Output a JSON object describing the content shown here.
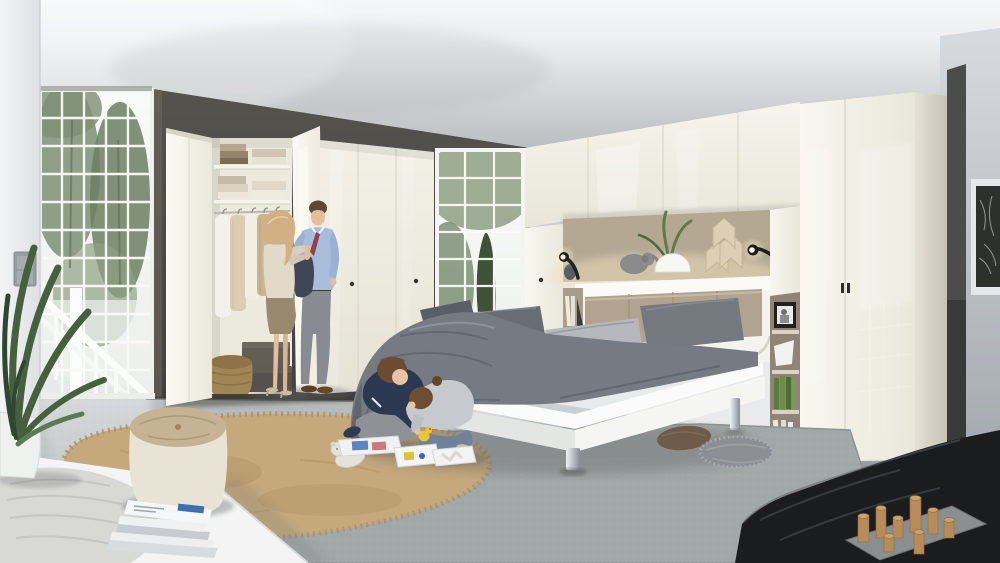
{
  "meta": {
    "type": "photograph",
    "subject": "Family of four in a bright showroom bedroom with white high-gloss fitted wardrobes, overbed storage bridge and grey bed"
  },
  "palette": {
    "accent_wall": "#55534e",
    "niche_taupe": "#b4a893",
    "headboard_taupe": "#b1a38f",
    "rug_grey": "#a2a7a7",
    "rug_tan": "#c5a87c",
    "pouf_body": "#e8e3d4",
    "pouf_top": "#c6b394",
    "ottoman_black": "#1b1c1e",
    "wood_block": "#b78c5a",
    "plant_green": "#46603f",
    "bed_grey": "#767a83",
    "pillow_light": "#b5b8bd",
    "man_shirt": "#a8bdda",
    "man_trousers": "#888b92",
    "woman_top": "#e2d9c8",
    "woman_skirt": "#99896f",
    "boy_sweater": "#2c3850",
    "girl_top": "#c6c9cd",
    "girl_jeans": "#70829b",
    "wardrobe_cream": "#f2efe5",
    "floor_front": "#a7acaf"
  },
  "scene": {
    "left_area": [
      "white structural column",
      "double light switch",
      "tall latticed window with trees and white porch railing",
      "dark taupe accent wall",
      "open high-gloss wardrobe with folded linens, hanging shirts, two storage cases and a wicker basket",
      "potted green plant",
      "white platform bench with knitted cushion",
      "cream pouf with tufted top",
      "stack of magazines",
      "shaggy beige rug"
    ],
    "center_area": [
      "man in blue shirt having his tie adjusted by woman in beige top and taupe skirt",
      "boy in navy sweater and girl in grey top playing with toy trays, picture books and a yellow duck",
      "white teddy bear",
      "double bed with grey bedding, white frame and chrome feet",
      "grey area rug"
    ],
    "right_area": [
      "overbed bridge wardrobe with lit niche",
      "elephant figurine",
      "white vase with grass leaves",
      "wooden chevron sculpture",
      "two black flexible reading lamps",
      "taupe padded headboard",
      "open shelf tower with black photo frame, folded card and green books",
      "tall high-gloss wardrobe",
      "dark feature wall strip",
      "framed botanical print on grey wall",
      "black leather ottoman with wooden peg game on a grey tray",
      "brown and grey floor cushions"
    ]
  }
}
